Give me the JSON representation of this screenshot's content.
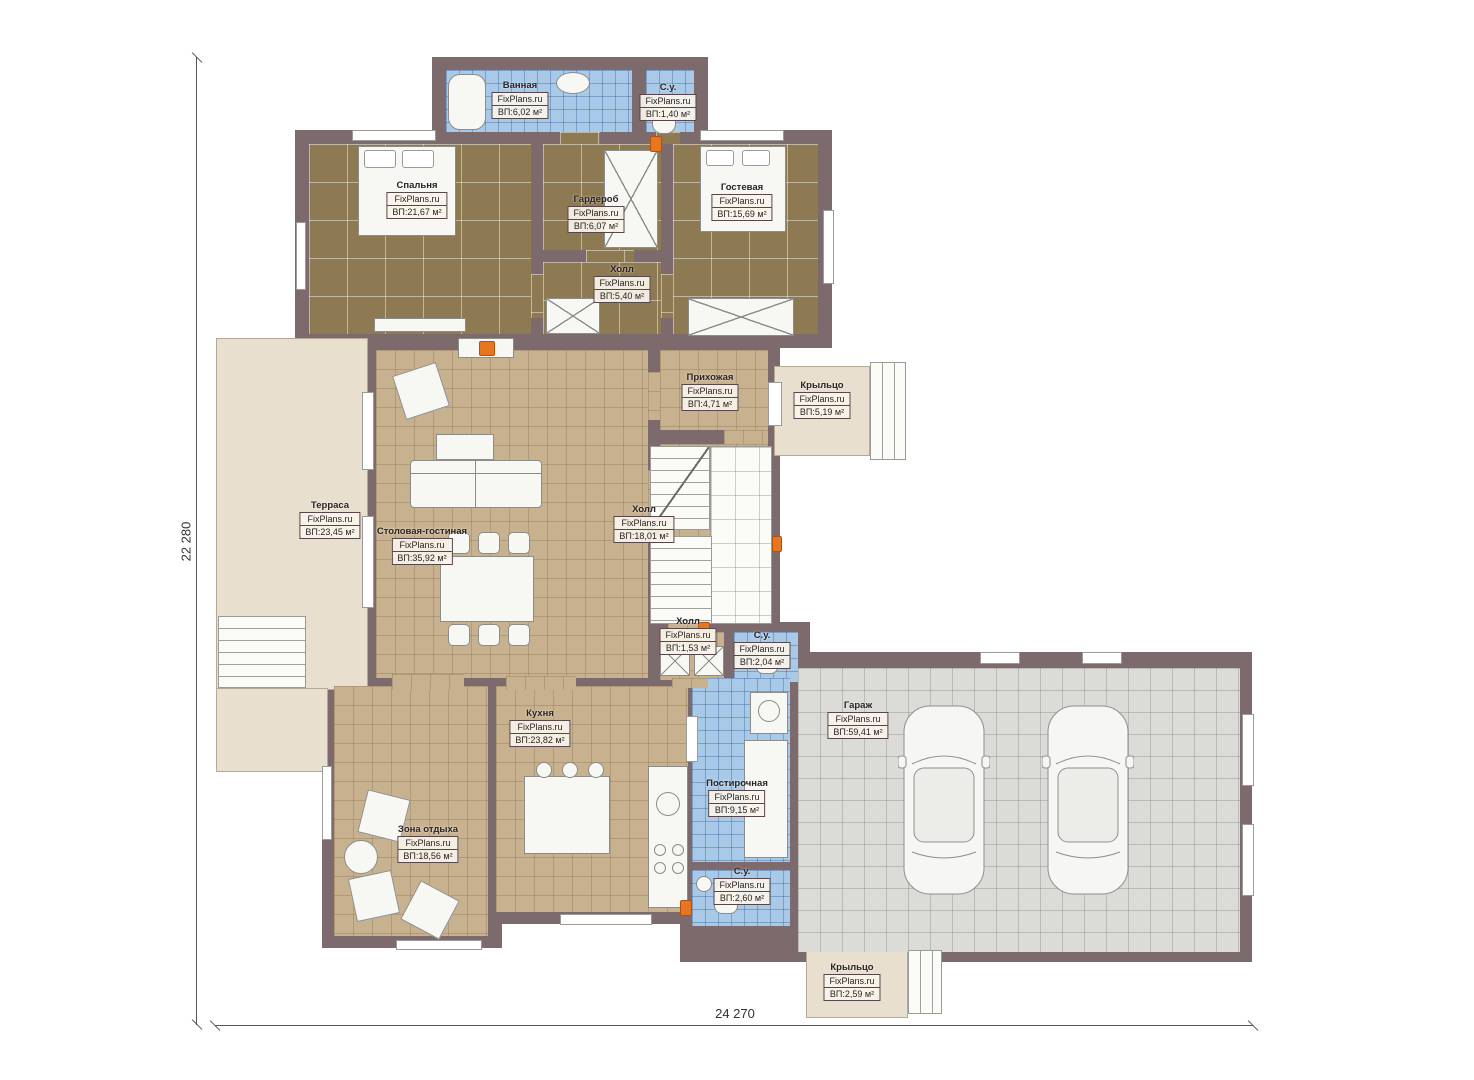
{
  "plan": {
    "brand": "FixPlans.ru",
    "dimensions": {
      "height_label": "22 280",
      "width_label": "24 270"
    },
    "rooms": [
      {
        "id": "bathroom-top",
        "name": "Ванная",
        "brand": "FixPlans.ru",
        "area": "ВП:6,02 м²"
      },
      {
        "id": "wc-top",
        "name": "С.у.",
        "brand": "FixPlans.ru",
        "area": "ВП:1,40 м²"
      },
      {
        "id": "bedroom",
        "name": "Спальня",
        "brand": "FixPlans.ru",
        "area": "ВП:21,67 м²"
      },
      {
        "id": "wardrobe",
        "name": "Гардероб",
        "brand": "FixPlans.ru",
        "area": "ВП:6,07 м²"
      },
      {
        "id": "hall-upper",
        "name": "Холл",
        "brand": "FixPlans.ru",
        "area": "ВП:5,40 м²"
      },
      {
        "id": "guest-room",
        "name": "Гостевая",
        "brand": "FixPlans.ru",
        "area": "ВП:15,69 м²"
      },
      {
        "id": "entry",
        "name": "Прихожая",
        "brand": "FixPlans.ru",
        "area": "ВП:4,71 м²"
      },
      {
        "id": "porch-right",
        "name": "Крыльцо",
        "brand": "FixPlans.ru",
        "area": "ВП:5,19 м²"
      },
      {
        "id": "terrace",
        "name": "Терраса",
        "brand": "FixPlans.ru",
        "area": "ВП:23,45 м²"
      },
      {
        "id": "dining-living",
        "name": "Столовая-гостиная",
        "brand": "FixPlans.ru",
        "area": "ВП:35,92 м²"
      },
      {
        "id": "hall-main",
        "name": "Холл",
        "brand": "FixPlans.ru",
        "area": "ВП:18,01 м²"
      },
      {
        "id": "hall-small",
        "name": "Холл",
        "brand": "FixPlans.ru",
        "area": "ВП:1,53 м²"
      },
      {
        "id": "wc-mid",
        "name": "С.у.",
        "brand": "FixPlans.ru",
        "area": "ВП:2,04 м²"
      },
      {
        "id": "kitchen",
        "name": "Кухня",
        "brand": "FixPlans.ru",
        "area": "ВП:23,82 м²"
      },
      {
        "id": "lounge",
        "name": "Зона отдыха",
        "brand": "FixPlans.ru",
        "area": "ВП:18,56 м²"
      },
      {
        "id": "laundry",
        "name": "Постирочная",
        "brand": "FixPlans.ru",
        "area": "ВП:9,15 м²"
      },
      {
        "id": "wc-low",
        "name": "С.у.",
        "brand": "FixPlans.ru",
        "area": "ВП:2,60 м²"
      },
      {
        "id": "garage",
        "name": "Гараж",
        "brand": "FixPlans.ru",
        "area": "ВП:59,41 м²"
      },
      {
        "id": "porch-bottom",
        "name": "Крыльцо",
        "brand": "FixPlans.ru",
        "area": "ВП:2,59 м²"
      }
    ]
  },
  "colors": {
    "wall": "#7d6a6c",
    "wood": "#8d7a52",
    "tile": "#c8b18e",
    "wet": "#a9c9e8",
    "garage": "#dbdbd7",
    "terrace": "#e8dfcf",
    "accent": "#e8751f",
    "dim": "#555555",
    "labelborder": "#57474a"
  }
}
